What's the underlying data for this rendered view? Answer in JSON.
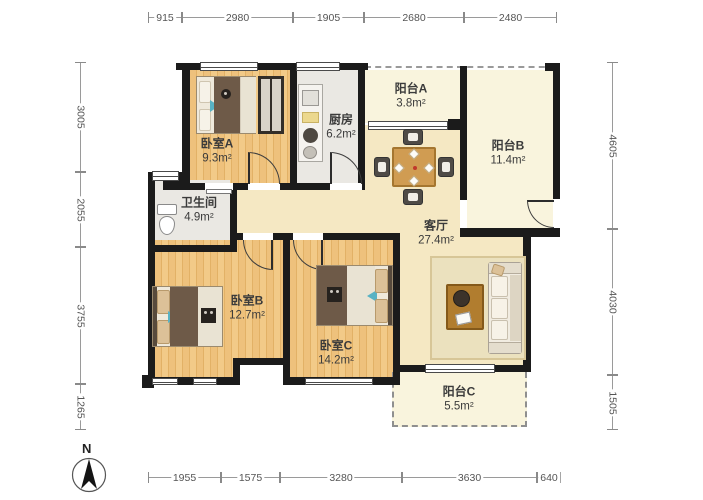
{
  "plan": {
    "compass_label": "N",
    "rooms": {
      "bedroom_a": {
        "name": "卧室A",
        "area": "9.3m²"
      },
      "kitchen": {
        "name": "厨房",
        "area": "6.2m²"
      },
      "balcony_a": {
        "name": "阳台A",
        "area": "3.8m²"
      },
      "balcony_b": {
        "name": "阳台B",
        "area": "11.4m²"
      },
      "bathroom": {
        "name": "卫生间",
        "area": "4.9m²"
      },
      "living_room": {
        "name": "客厅",
        "area": "27.4m²"
      },
      "bedroom_b": {
        "name": "卧室B",
        "area": "12.7m²"
      },
      "bedroom_c": {
        "name": "卧室C",
        "area": "14.2m²"
      },
      "balcony_c": {
        "name": "阳台C",
        "area": "5.5m²"
      }
    },
    "dimensions": {
      "top": [
        "915",
        "2980",
        "1905",
        "2680",
        "2480"
      ],
      "left": [
        "3005",
        "2055",
        "3755",
        "1265"
      ],
      "right": [
        "4605",
        "4030",
        "1505"
      ],
      "bottom": [
        "1955",
        "1575",
        "3280",
        "3630",
        "640"
      ]
    },
    "colors": {
      "wall": "#1b1b1b",
      "wood_floor": "#eec17c",
      "tile_floor": "#eae8e3",
      "living_floor": "#f5e8c3",
      "balcony_floor": "#f9f4dd"
    }
  }
}
